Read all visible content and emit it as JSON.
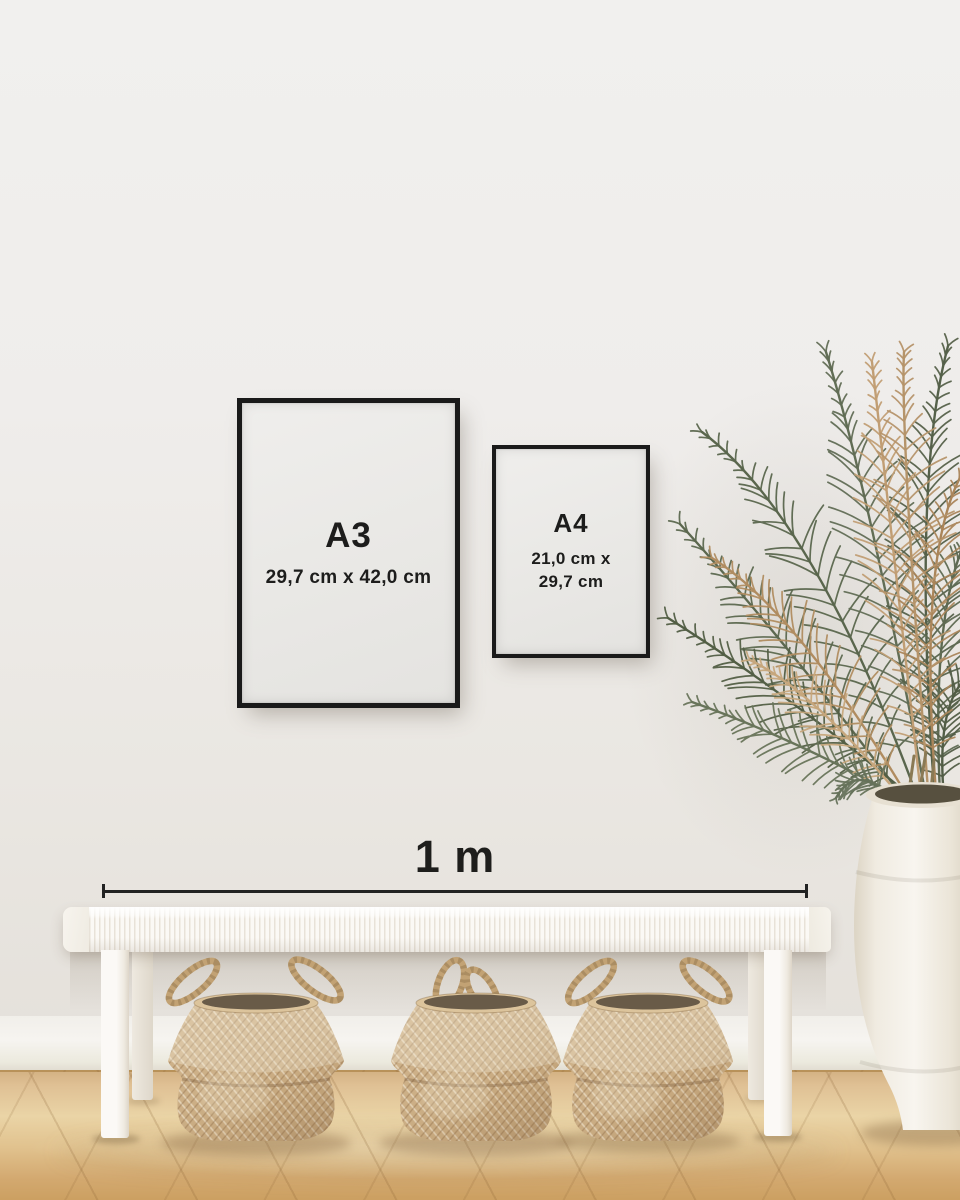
{
  "frames": {
    "a3": {
      "label": "A3",
      "dimensions": "29,7 cm x 42,0 cm"
    },
    "a4": {
      "label": "A4",
      "dimensions_line1": "21,0 cm x",
      "dimensions_line2": "29,7 cm"
    }
  },
  "scale_bar": {
    "label": "1 m"
  },
  "palette": {
    "wall": "#efedea",
    "baseboard": "#f4f2ee",
    "floor_light": "#ecd7ab",
    "floor_dark": "#cda263",
    "frame_black": "#1a1a1a",
    "poster_white": "#ebeae8",
    "text": "#1d1d1c",
    "bench_white": "#f7f5f0",
    "basket_tan": "#cdb087",
    "vase_white": "#f4f0e8",
    "plant_green": "#5c684f",
    "plant_tan": "#b8956a",
    "measure_line": "#222222"
  }
}
